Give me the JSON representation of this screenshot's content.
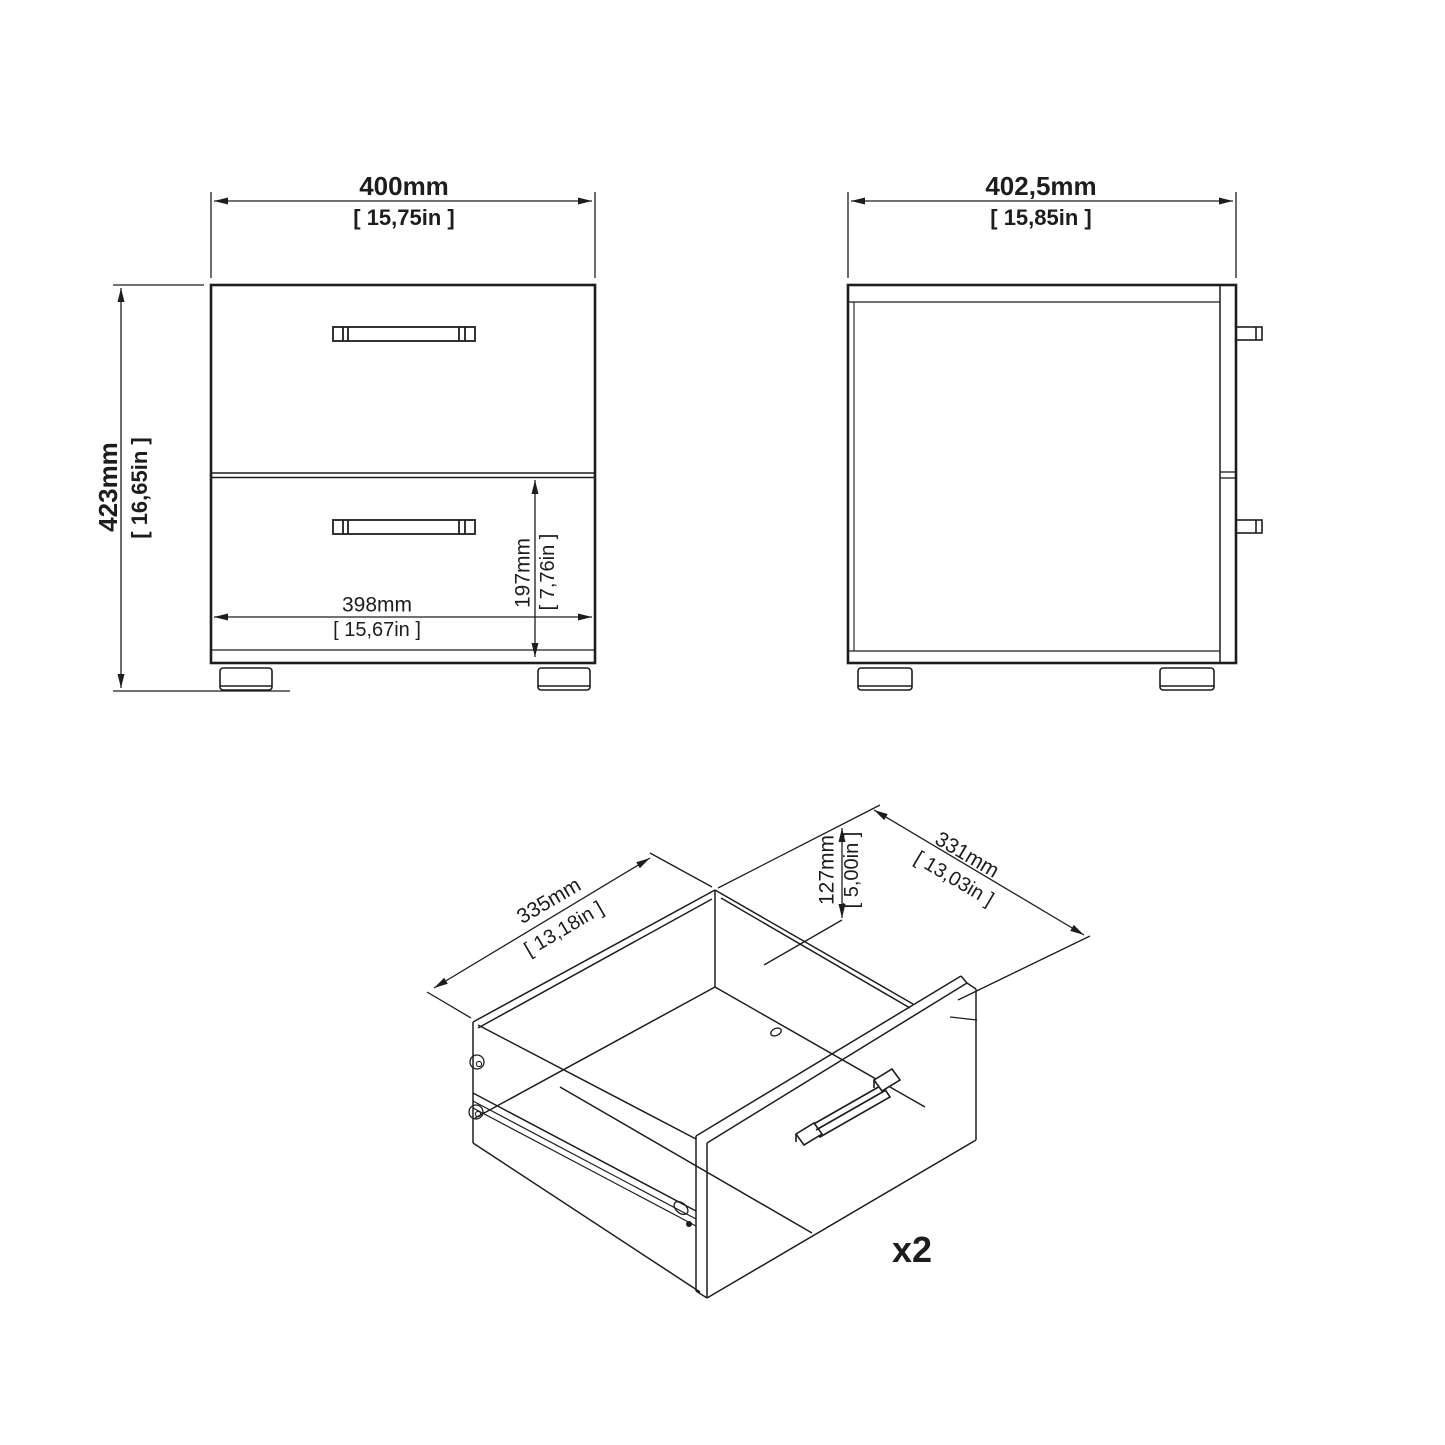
{
  "diagram": {
    "front_view": {
      "width_mm": "400mm",
      "width_in": "[ 15,75in ]",
      "height_mm": "423mm",
      "height_in": "[ 16,65in ]",
      "inner_width_mm": "398mm",
      "inner_width_in": "[ 15,67in ]",
      "drawer_height_mm": "197mm",
      "drawer_height_in": "[ 7,76in ]"
    },
    "side_view": {
      "depth_mm": "402,5mm",
      "depth_in": "[ 15,85in ]"
    },
    "drawer_view": {
      "inner_depth_mm": "335mm",
      "inner_depth_in": "[ 13,18in ]",
      "inner_width_mm": "331mm",
      "inner_width_in": "[ 13,03in ]",
      "inner_height_mm": "127mm",
      "inner_height_in": "[ 5,00in ]",
      "quantity_label": "x2"
    },
    "colors": {
      "line": "#1d1d1b",
      "background": "#ffffff"
    }
  }
}
